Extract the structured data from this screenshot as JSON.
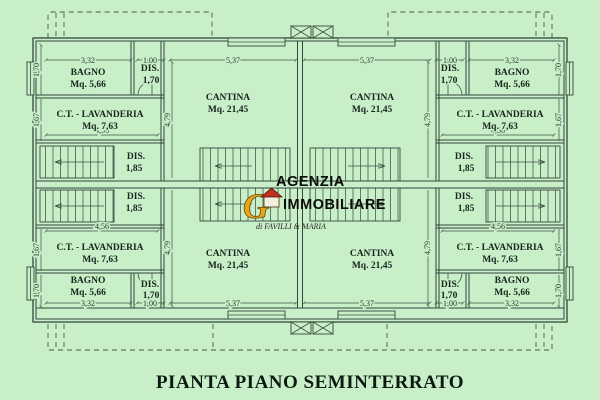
{
  "title": "PIANTA PIANO SEMINTERRATO",
  "watermark": {
    "line1": "AGENZIA",
    "line2": "IMMOBILIARE",
    "tagline": "di FAVILLI & MARIA",
    "logo_letter": "G"
  },
  "colors": {
    "background": "#c9efc9",
    "line": "#35463c",
    "text": "#16251c",
    "logo_gold": "#e8a81e",
    "logo_red": "#c03020"
  },
  "rooms": {
    "bagno": {
      "name": "BAGNO",
      "area": "Mq. 5,66"
    },
    "dis_small": {
      "name": "DIS.",
      "area": "1,70"
    },
    "lavanderia": {
      "name": "C.T. - LAVANDERIA",
      "area": "Mq. 7,63"
    },
    "dis_mid": {
      "name": "DIS.",
      "area": "1,85"
    },
    "cantina": {
      "name": "CANTINA",
      "area": "Mq. 21,45"
    }
  },
  "dims": {
    "bagno_w": "3,32",
    "dis_w": "1,00",
    "cantina_w": "5,37",
    "lav_w": "4,56",
    "bagno_h": "1,70",
    "lav_h": "1,67",
    "cantina_h": "4,79"
  }
}
